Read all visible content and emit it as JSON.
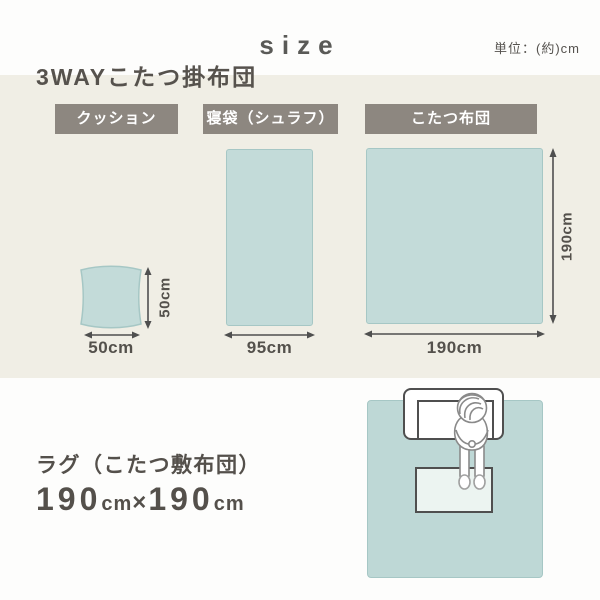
{
  "header": {
    "title": "size",
    "unit_note": "単位：(約)cm"
  },
  "futon_section": {
    "heading": "3WAYこたつ掛布団",
    "items": [
      {
        "label": "クッション",
        "width": "50cm",
        "height": "50cm"
      },
      {
        "label": "寝袋（シュラフ）",
        "width": "95cm"
      },
      {
        "label": "こたつ布団",
        "width": "190cm",
        "height": "190cm"
      }
    ]
  },
  "rug_section": {
    "heading": "ラグ（こたつ敷布団）",
    "size": {
      "width_value": "190",
      "width_unit": "cm",
      "separator": "×",
      "height_value": "190",
      "height_unit": "cm"
    }
  },
  "colors": {
    "teal_fill": "#c3dbd9",
    "teal_border": "#a6c7c5",
    "rug_fill": "#bed8d6",
    "beige_panel": "#f0eee5",
    "label_badge_bg": "#8d8780",
    "text_dark": "#54514c",
    "arrow": "#4f4f4f"
  }
}
